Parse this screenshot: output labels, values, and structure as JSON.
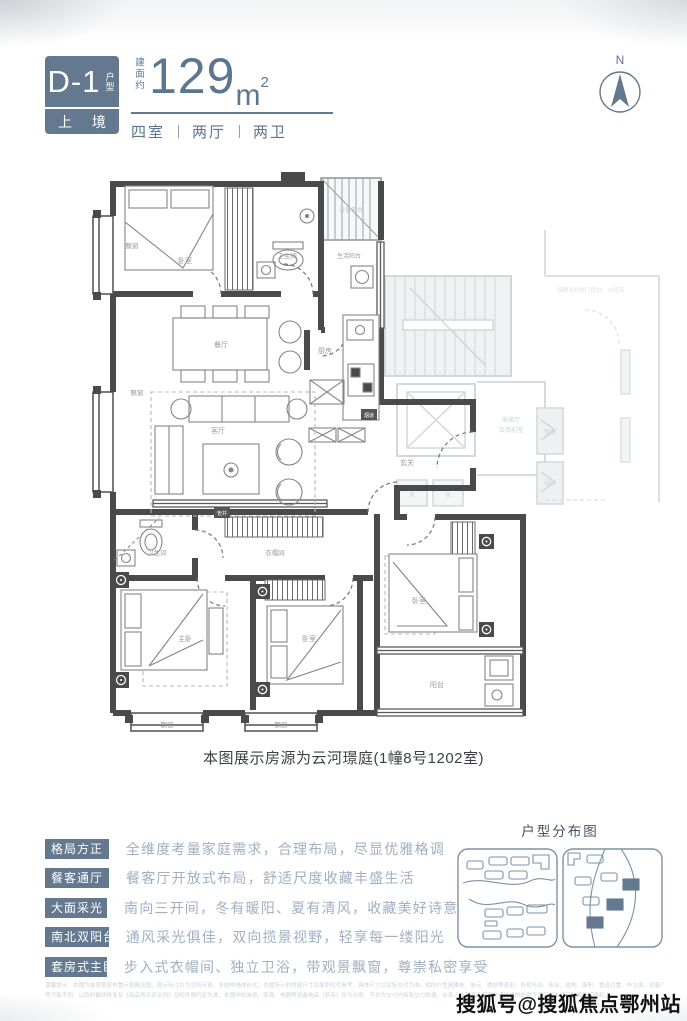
{
  "header": {
    "model": "D-1",
    "model_suffix": "户型",
    "brand": "上 境",
    "area_prefix": "建面约",
    "area_value": "129",
    "area_unit": "m",
    "area_sup": "2",
    "rooms": [
      "四室",
      "两厅",
      "两卫"
    ]
  },
  "compass": {
    "label": "N"
  },
  "caption": "本图展示房源为云河璟庭(1幢8号1202室)",
  "features": {
    "items": [
      {
        "tag": "格局方正",
        "desc": "全维度考量家庭需求，合理布局，尽显优雅格调"
      },
      {
        "tag": "餐客通厅",
        "desc": "餐客厅开放式布局，舒适尺度收藏丰盛生活"
      },
      {
        "tag": "大面采光",
        "desc": "南向三开间，冬有暖阳、夏有清风，收藏美好诗意"
      },
      {
        "tag": "南北双阳台",
        "desc": "通风采光俱佳，双向揽景视野，轻享每一缕阳光"
      },
      {
        "tag": "套房式主卧",
        "desc": "步入式衣帽间、独立卫浴，带观景飘窗，尊崇私密享受"
      }
    ]
  },
  "sitemap": {
    "title": "户型分布图"
  },
  "disclaimer": {
    "line1": "温馨提示：本图为装修家居布置示意概念图，图示标注仅为空间示意、非结构墙体形式；本图所示的房屋尺寸及面积仅供参考，具体尺寸以实际交付为准。相同户型因楼栋、单元、楼层等差别，所视开间、阳台、结构、面积、管道位置、外立面、设备平台",
    "line2": "等可能不同，以政府最终批准及《商品房买卖合同》及附件等约定为准；本图中的装修、家具、电器等设备物品（若有）仅为示意，不作为交付内容和交付依据。出卖人在不违反国家法律法规的前提下保留对本资料的最终解释权。"
  },
  "watermark": "搜狐号@搜狐焦点鄂州站",
  "colors": {
    "accent": "#64798f",
    "wall": "#4a4a4a",
    "muted_text": "#9fb0c1",
    "faint": "#d3d7da"
  },
  "floorplan": {
    "labels": [
      {
        "label": "飘窗",
        "x": 47,
        "y": 78,
        "s": 6.5
      },
      {
        "label": "卧室",
        "x": 100,
        "y": 93
      },
      {
        "label": "卫生间",
        "x": 202,
        "y": 88,
        "s": 6.5
      },
      {
        "label": "生活阳台",
        "x": 264,
        "y": 88,
        "s": 6
      },
      {
        "label": "设备平台",
        "x": 266,
        "y": 42,
        "s": 6,
        "c": "#c2c7cb"
      },
      {
        "label": "餐厅",
        "x": 136,
        "y": 177
      },
      {
        "label": "厨房",
        "x": 240,
        "y": 183
      },
      {
        "label": "飘窗",
        "x": 52,
        "y": 225,
        "s": 6.5
      },
      {
        "label": "客厅",
        "x": 133,
        "y": 263
      },
      {
        "label": "玄关",
        "x": 322,
        "y": 295
      },
      {
        "label": "烟道",
        "x": 284,
        "y": 247,
        "inv": true,
        "s": 5
      },
      {
        "label": "管井",
        "x": 137,
        "y": 345,
        "inv": true,
        "s": 5
      },
      {
        "label": "卫生间",
        "x": 72,
        "y": 385,
        "s": 6.5
      },
      {
        "label": "衣帽间",
        "x": 190,
        "y": 385,
        "s": 6.5
      },
      {
        "label": "主卧",
        "x": 100,
        "y": 471
      },
      {
        "label": "卧室",
        "x": 224,
        "y": 471
      },
      {
        "label": "卧室",
        "x": 334,
        "y": 433
      },
      {
        "label": "阳台",
        "x": 352,
        "y": 517
      },
      {
        "label": "飘窗",
        "x": 82,
        "y": 557,
        "s": 6.5
      },
      {
        "label": "飘窗",
        "x": 196,
        "y": 557,
        "s": 6.5
      },
      {
        "label": "电梯厅",
        "x": 426,
        "y": 252,
        "s": 6.2,
        "c": "#cfd4d8"
      },
      {
        "label": "合用前室",
        "x": 426,
        "y": 262,
        "s": 6.2,
        "c": "#cfd4d8"
      },
      {
        "label": "强电",
        "x": 465,
        "y": 264,
        "s": 6,
        "c": "#cfd4d8"
      },
      {
        "label": "弱电",
        "x": 465,
        "y": 315,
        "s": 6,
        "c": "#cfd4d8"
      },
      {
        "label": "风",
        "x": 327,
        "y": 327,
        "s": 6,
        "c": "#cfd4d8"
      },
      {
        "label": "水",
        "x": 363,
        "y": 327,
        "s": 6,
        "c": "#cfd4d8"
      },
      {
        "label": "疏散及检修门仅12、15层有",
        "x": 506,
        "y": 122,
        "s": 5.5,
        "c": "#dde1e4"
      }
    ]
  }
}
